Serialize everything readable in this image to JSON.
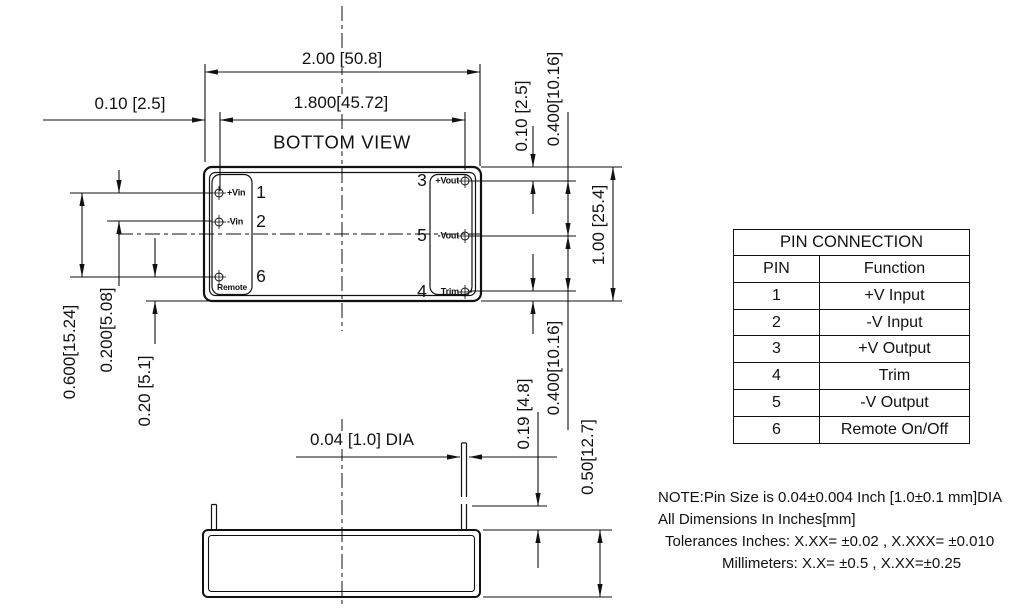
{
  "colors": {
    "line": "#111111",
    "background": "#ffffff"
  },
  "bottom_view": {
    "title": "BOTTOM VIEW",
    "pins_left": [
      {
        "number": "1",
        "label": "+Vin"
      },
      {
        "number": "2",
        "label": "-Vin"
      },
      {
        "number": "6",
        "label": "Remote"
      }
    ],
    "pins_right": [
      {
        "number": "3",
        "label": "+Vout"
      },
      {
        "number": "5",
        "label": "-Vout"
      },
      {
        "number": "4",
        "label": "Trim"
      }
    ]
  },
  "dimensions": {
    "body_width": "2.00 [50.8]",
    "pin_span_width": "1.800[45.72]",
    "left_pin_margin": "0.10 [2.5]",
    "right_top_margin": "0.10 [2.5]",
    "right_pin_pitch_upper": "0.400[10.16]",
    "body_height": "1.00 [25.4]",
    "left_pin_span": "0.600[15.24]",
    "left_pin_pitch": "0.200[5.08]",
    "left_bottom_offset": "0.20 [5.1]",
    "pin_length": "0.19 [4.8]",
    "right_pin_pitch_lower": "0.400[10.16]",
    "case_height": "0.50[12.7]",
    "pin_diameter": "0.04 [1.0] DIA"
  },
  "pin_table": {
    "title": "PIN CONNECTION",
    "col_pin": "PIN",
    "col_function": "Function",
    "rows": [
      {
        "pin": "1",
        "function": "+V Input"
      },
      {
        "pin": "2",
        "function": "-V Input"
      },
      {
        "pin": "3",
        "function": "+V Output"
      },
      {
        "pin": "4",
        "function": "Trim"
      },
      {
        "pin": "5",
        "function": "-V Output"
      },
      {
        "pin": "6",
        "function": "Remote On/Off"
      }
    ]
  },
  "notes": {
    "line1": "NOTE:Pin Size is 0.04±0.004 Inch [1.0±0.1 mm]DIA",
    "line2": "All Dimensions In Inches[mm]",
    "line3": "Tolerances Inches: X.XX= ±0.02 , X.XXX= ±0.010",
    "line4": "Millimeters: X.X= ±0.5 , X.XX=±0.25"
  }
}
